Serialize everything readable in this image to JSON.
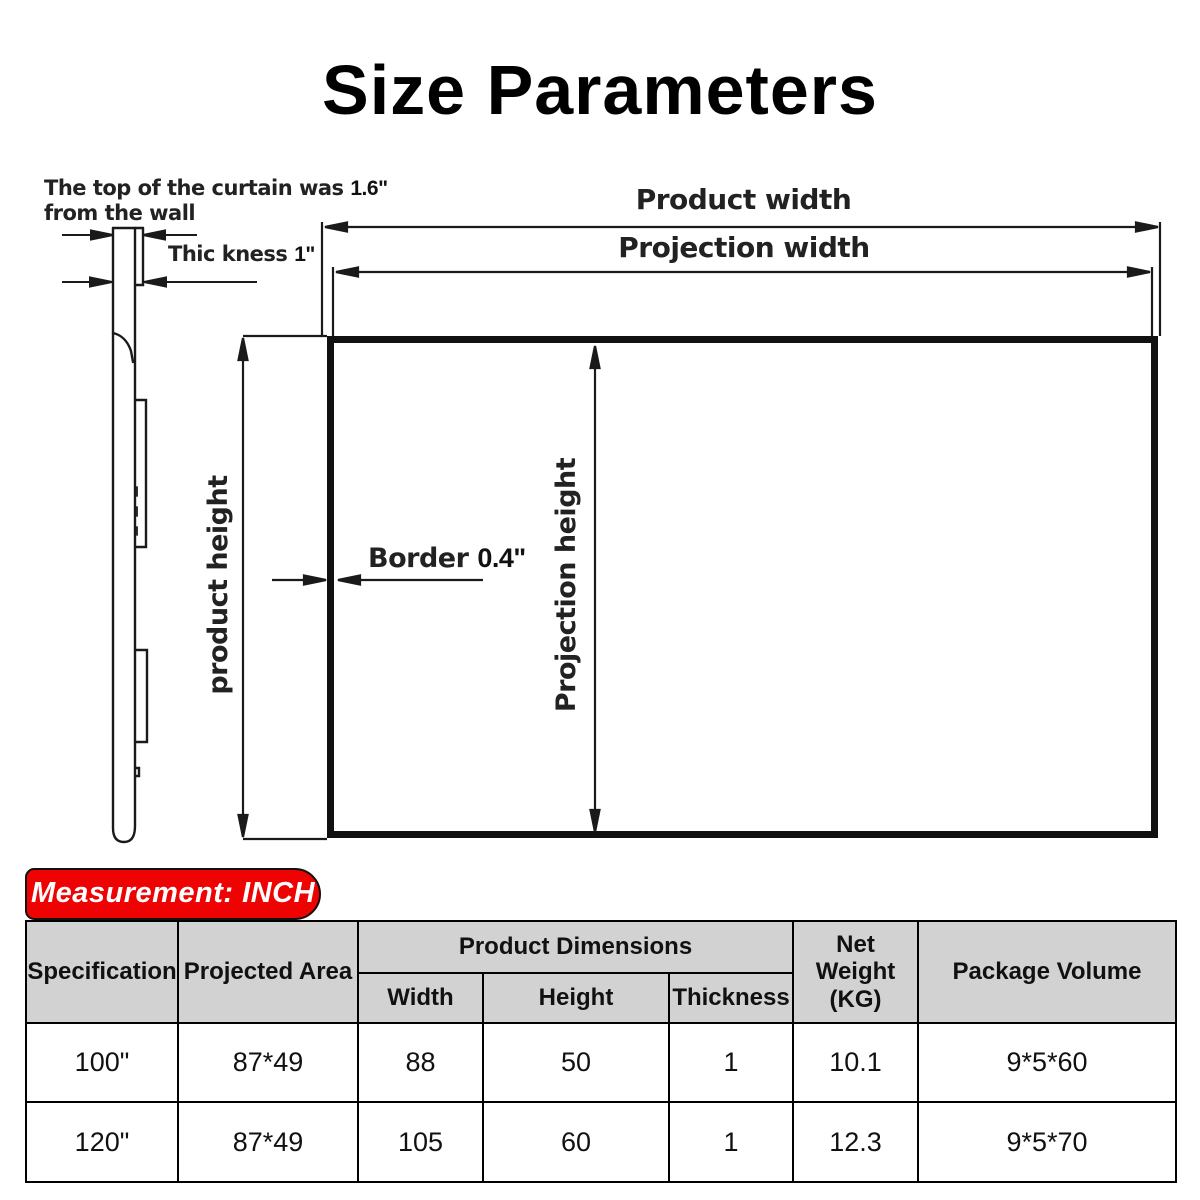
{
  "title": "Size Parameters",
  "colors": {
    "accent_red": "#ee0202",
    "table_header_bg": "#d2d2d2",
    "line_color": "#1a1a1a"
  },
  "diagram": {
    "curtain_note_line1": "The top of the curtain was",
    "curtain_note_value": "1.6\"",
    "curtain_note_line2": "from the wall",
    "thickness_label": "Thic kness",
    "thickness_value": "1\"",
    "product_width_label": "Product width",
    "projection_width_label": "Projection width",
    "product_height_label": "product height",
    "projection_height_label": "Projection height",
    "border_label": "Border",
    "border_value": "0.4\""
  },
  "measurement_badge": "Measurement: INCH",
  "table": {
    "headers": {
      "specification": "Specification",
      "projected_area": "Projected Area",
      "product_dimensions": "Product Dimensions",
      "width": "Width",
      "height": "Height",
      "thickness": "Thickness",
      "net_weight_line1": "Net Weight",
      "net_weight_line2": "(KG)",
      "package_volume": "Package Volume"
    },
    "rows": [
      {
        "specification": "100\"",
        "projected_area": "87*49",
        "width": "88",
        "height": "50",
        "thickness": "1",
        "net_weight": "10.1",
        "package_volume": "9*5*60"
      },
      {
        "specification": "120\"",
        "projected_area": "87*49",
        "width": "105",
        "height": "60",
        "thickness": "1",
        "net_weight": "12.3",
        "package_volume": "9*5*70"
      }
    ]
  }
}
